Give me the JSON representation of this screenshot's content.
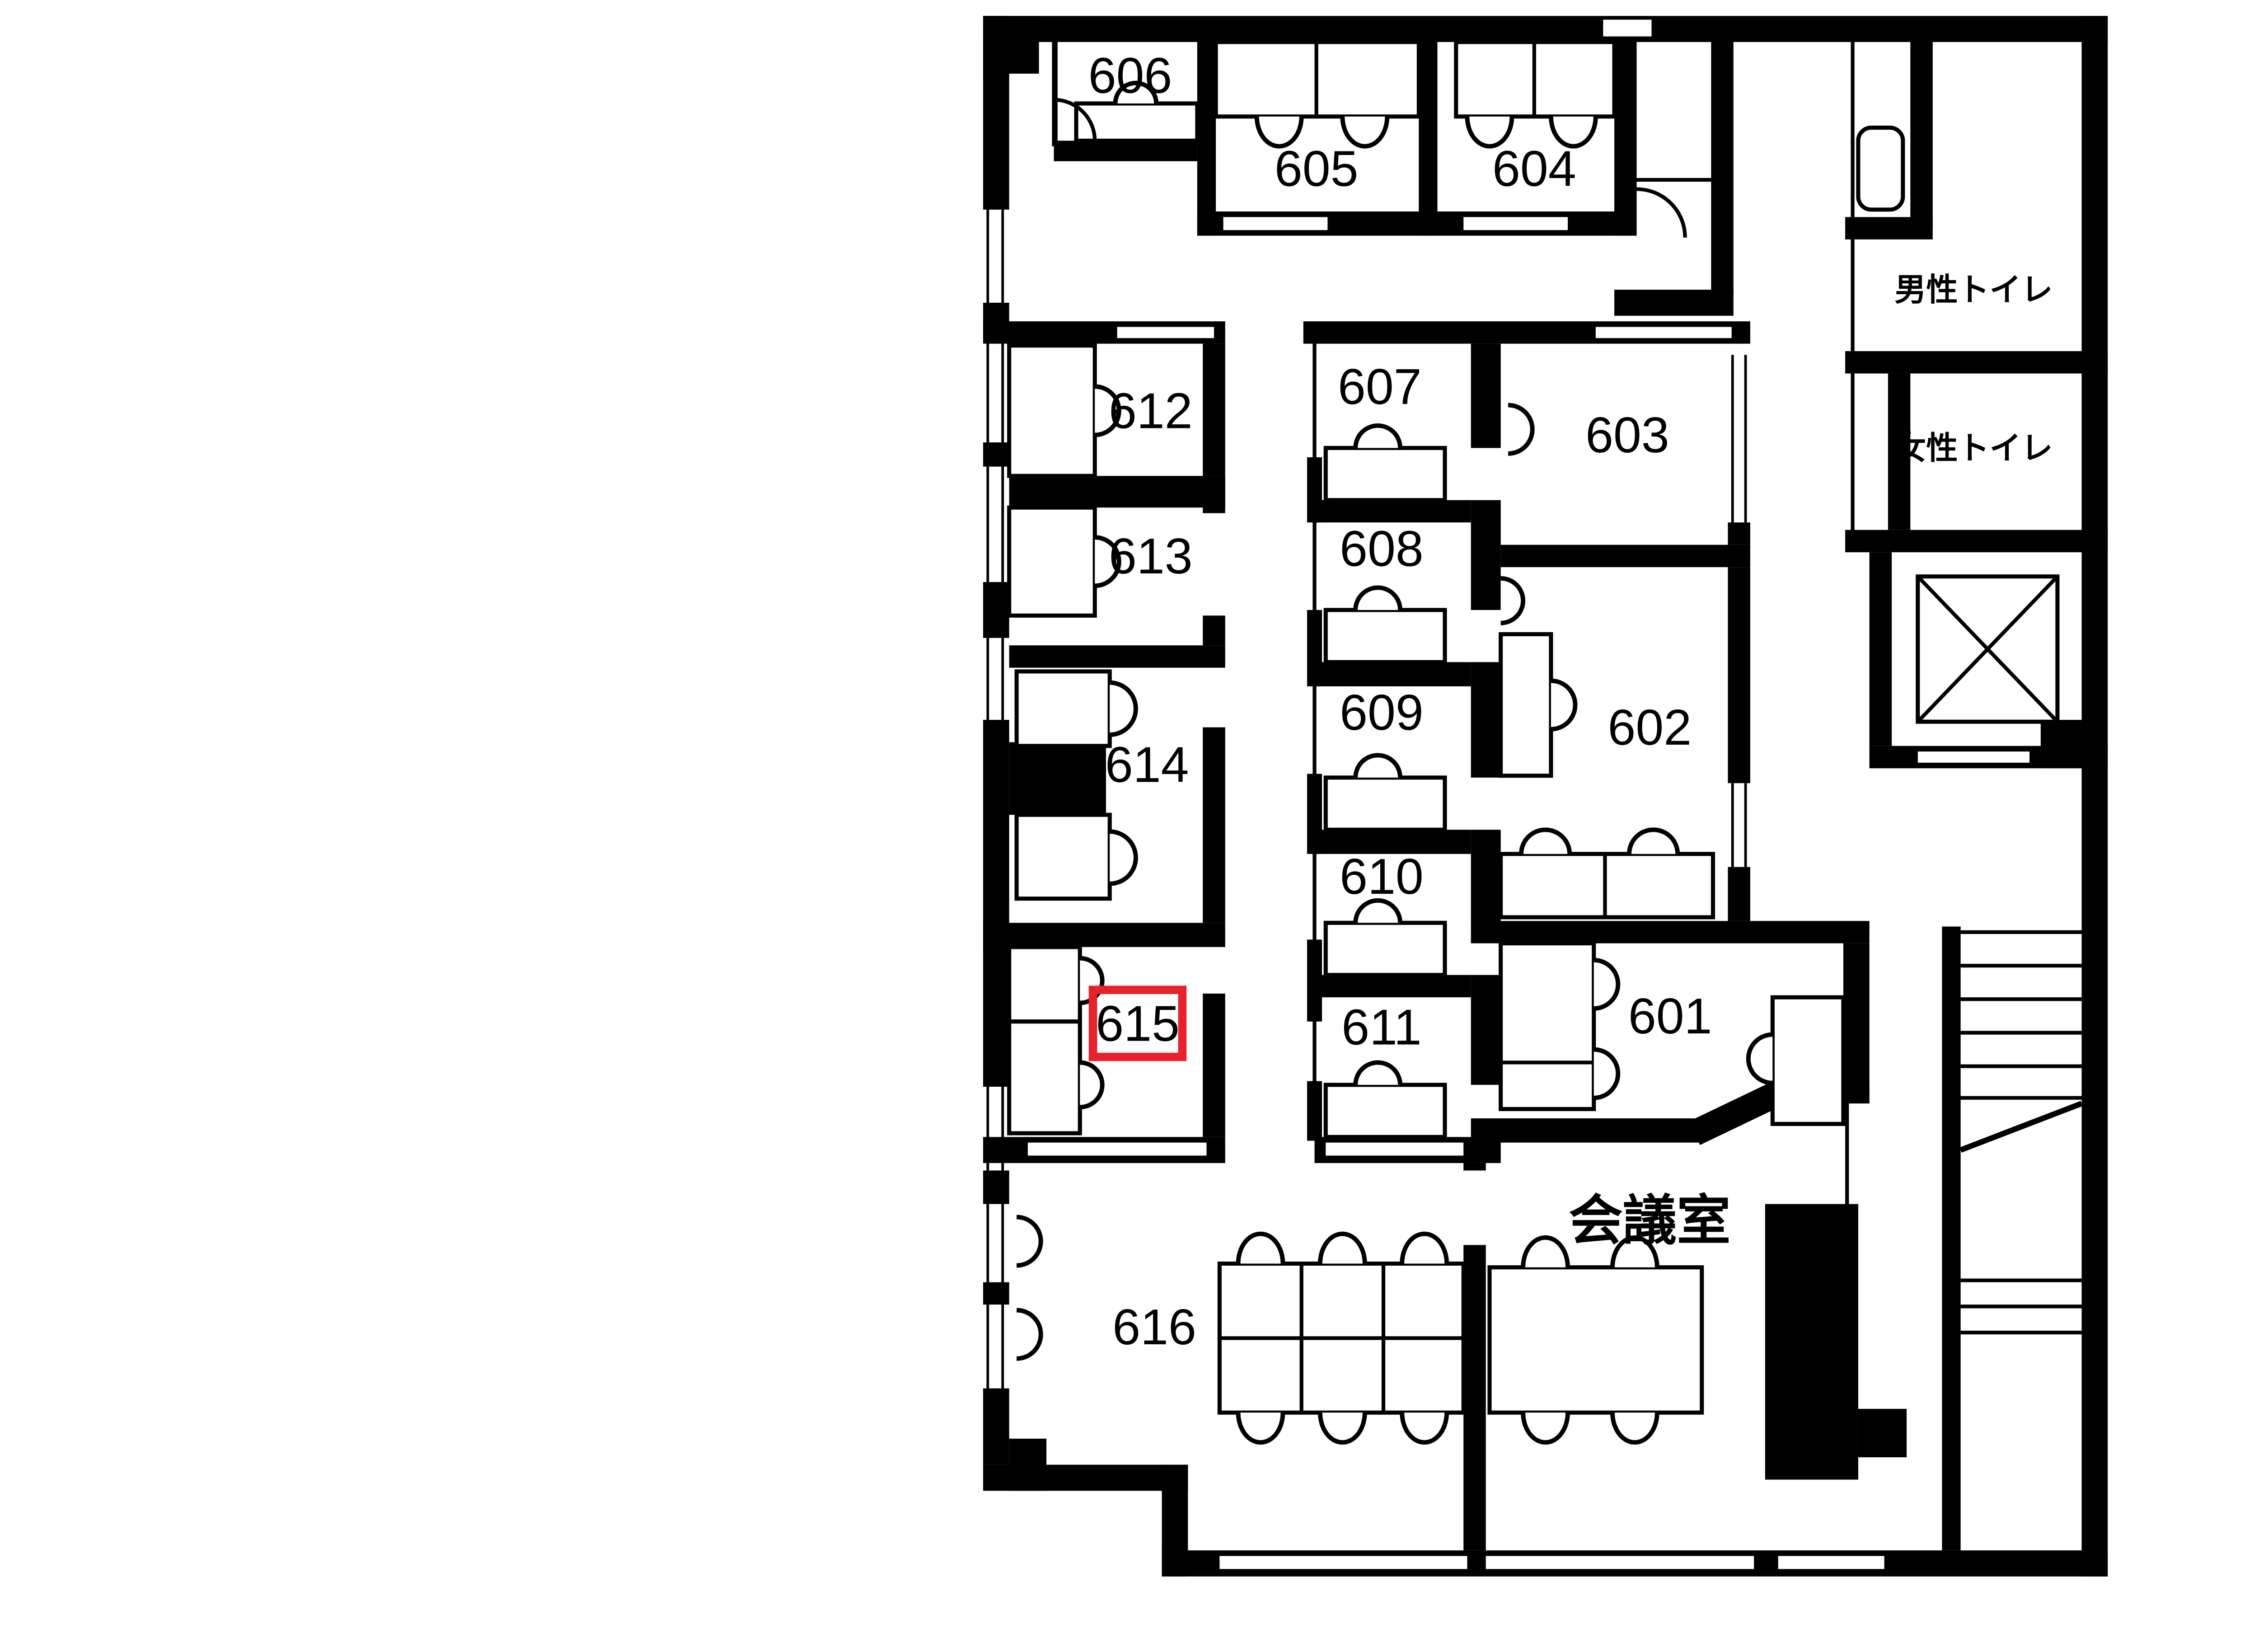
{
  "title": "office-floor-plan-6f",
  "colors": {
    "wall": "#000000",
    "background": "#ffffff",
    "highlight": "#e8212b"
  },
  "rooms": {
    "601": {
      "label": "601"
    },
    "602": {
      "label": "602"
    },
    "603": {
      "label": "603"
    },
    "604": {
      "label": "604"
    },
    "605": {
      "label": "605"
    },
    "606": {
      "label": "606"
    },
    "607": {
      "label": "607"
    },
    "608": {
      "label": "608"
    },
    "609": {
      "label": "609"
    },
    "610": {
      "label": "610"
    },
    "611": {
      "label": "611"
    },
    "612": {
      "label": "612"
    },
    "613": {
      "label": "613"
    },
    "614": {
      "label": "614"
    },
    "615": {
      "label": "615"
    },
    "616": {
      "label": "616"
    }
  },
  "facilities": {
    "mens_toilet": "男性トイレ",
    "womens_toilet": "女性トイレ",
    "meeting_room": "会議室"
  },
  "highlight": {
    "room": "615",
    "color": "#e8212b"
  }
}
